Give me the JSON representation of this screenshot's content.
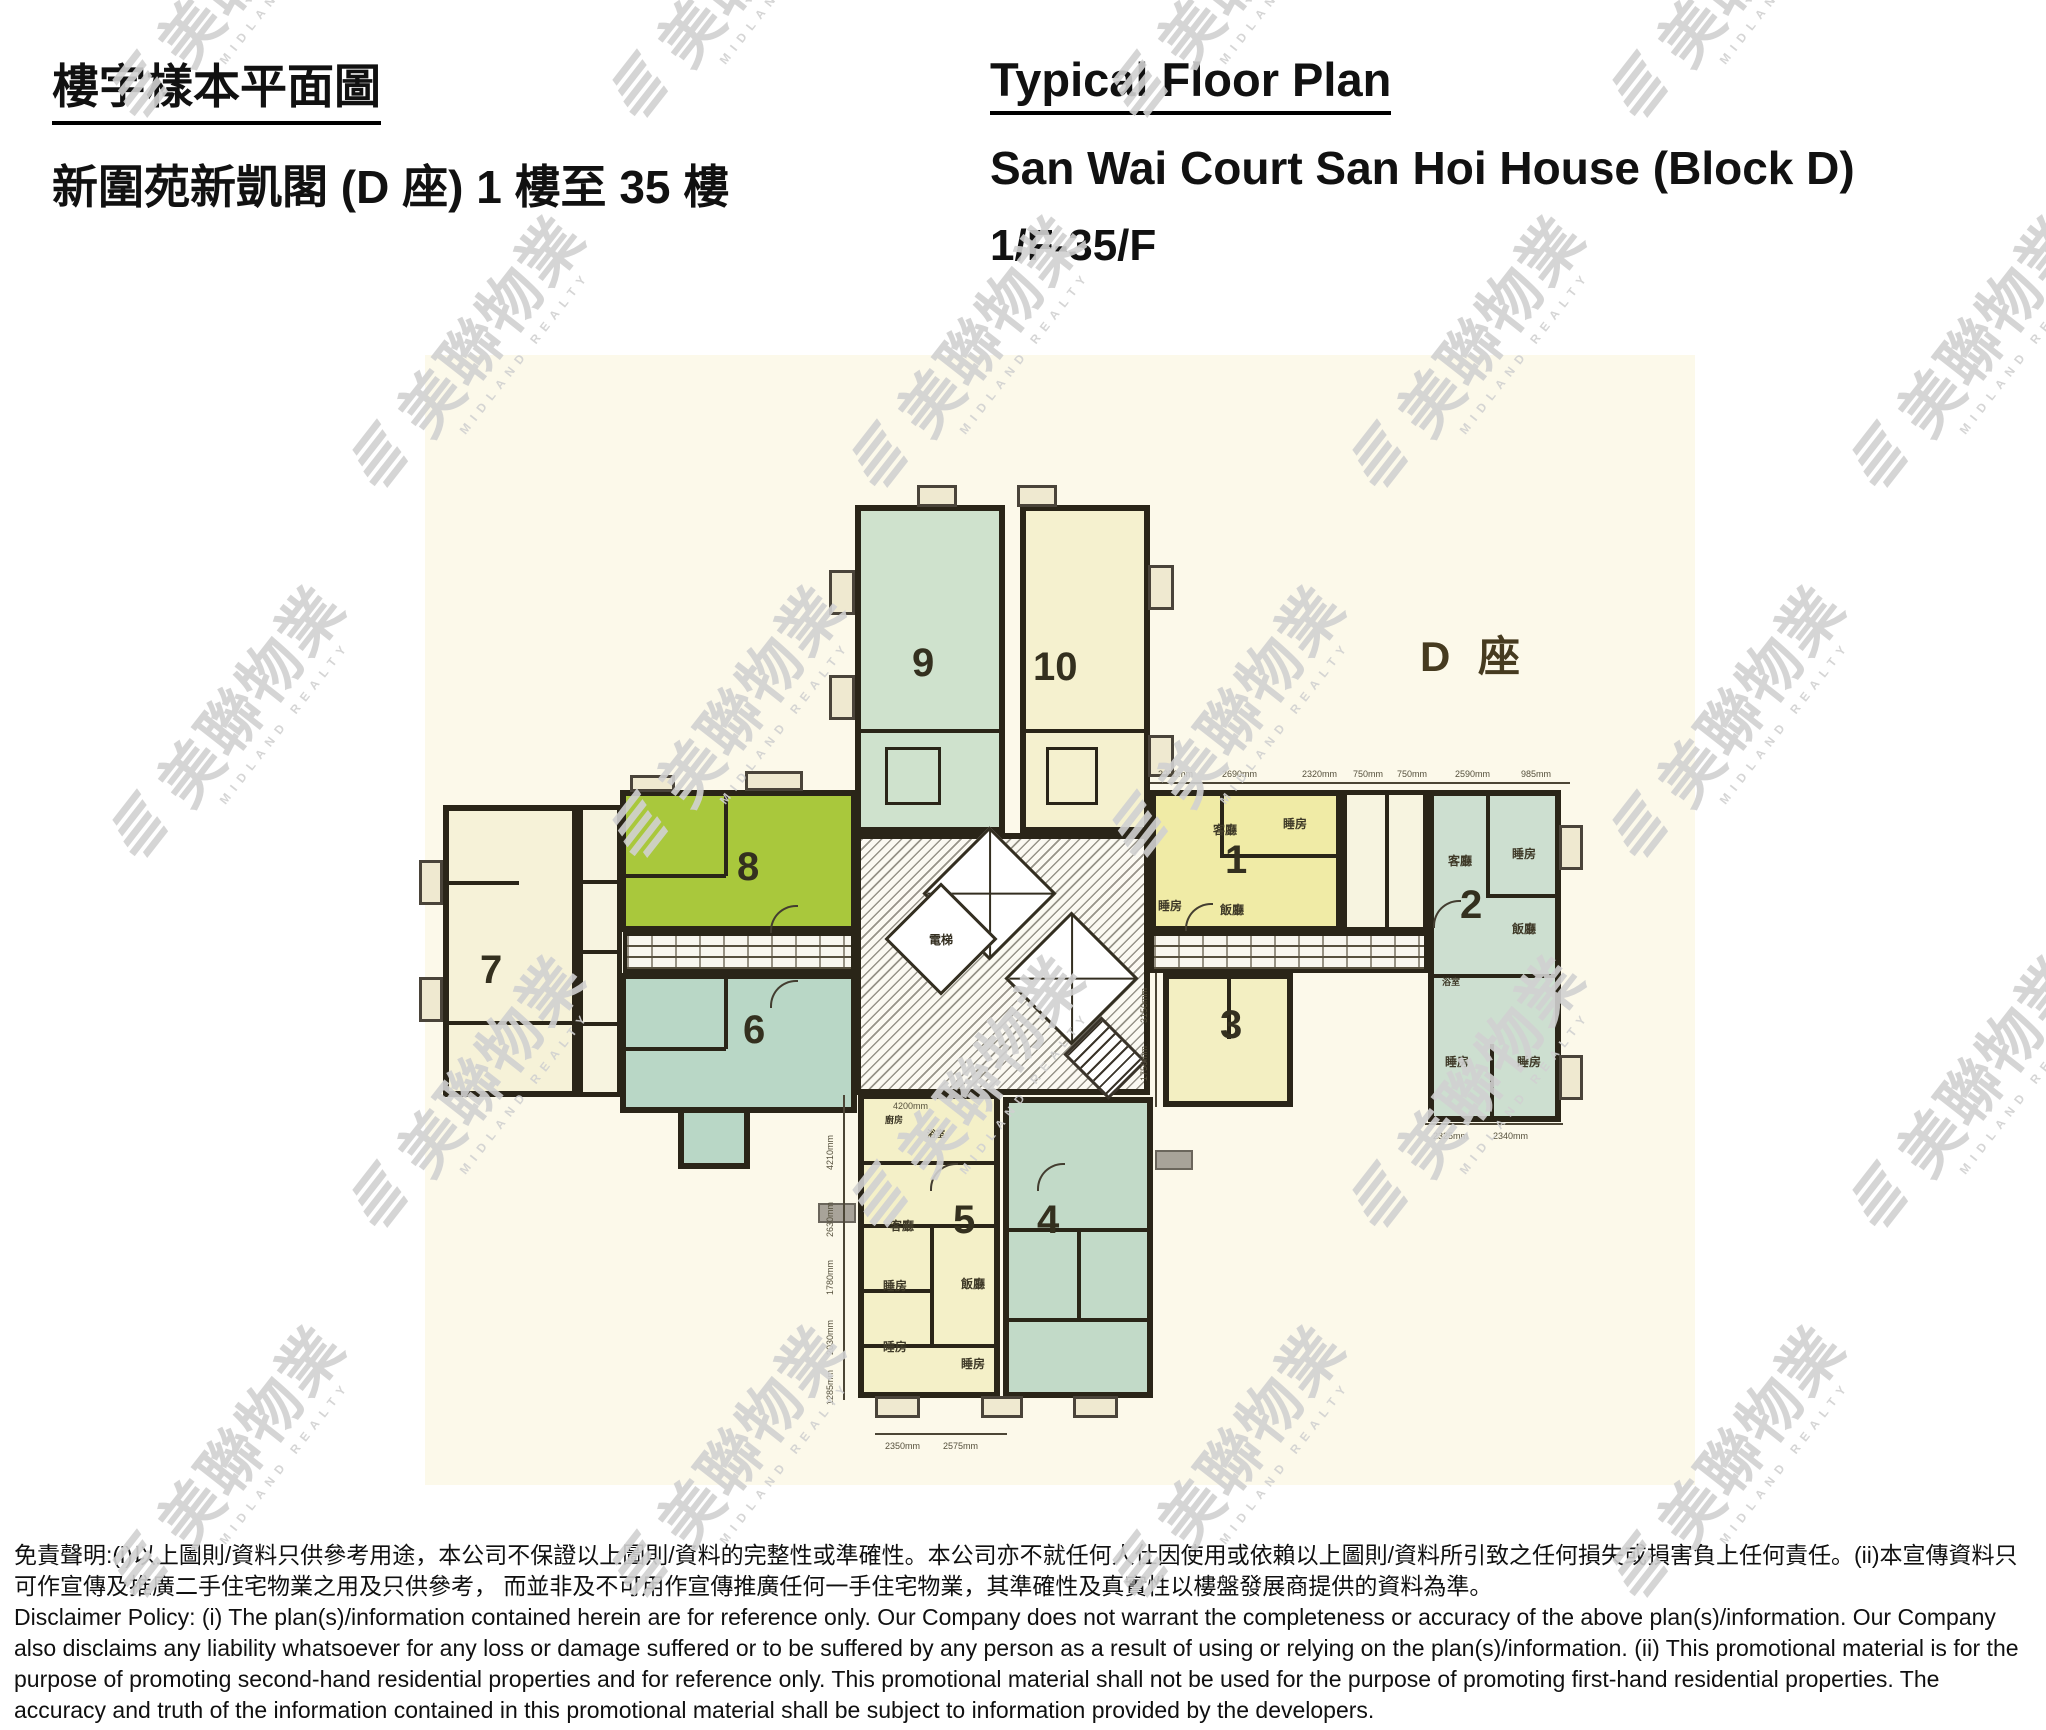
{
  "header": {
    "zh_title": "樓宇樣本平面圖",
    "zh_subtitle": "新圍苑新凱閣  (D 座) 1 樓至 35 樓",
    "en_title": "Typical Floor Plan",
    "en_subtitle": "San Wai Court San Hoi House (Block D)",
    "en_floors": "1/F-35/F"
  },
  "plan": {
    "block_label": "D 座",
    "labels": {
      "living": "客廳",
      "bedroom": "睡房",
      "dining": "飯廳",
      "bath": "浴室",
      "kitchen": "廚房",
      "lift": "電梯"
    },
    "units": [
      {
        "no": "1",
        "color": "#f0eba6"
      },
      {
        "no": "2",
        "color": "#cddfd0"
      },
      {
        "no": "3",
        "color": "#f3efc2"
      },
      {
        "no": "4",
        "color": "#c2dac8"
      },
      {
        "no": "5",
        "color": "#f4f0c8"
      },
      {
        "no": "6",
        "color": "#b9d7c6"
      },
      {
        "no": "7",
        "color": "#f6f2d8"
      },
      {
        "no": "8",
        "color": "#a9c83c"
      },
      {
        "no": "9",
        "color": "#cfe2cd"
      },
      {
        "no": "10",
        "color": "#f5f1cf"
      }
    ],
    "dims": {
      "top": [
        "2250mm",
        "2690mm",
        "2320mm",
        "750mm",
        "750mm",
        "2590mm",
        "985mm"
      ],
      "right_bottom": [
        "2325mm",
        "2340mm"
      ],
      "bottom": [
        "2350mm",
        "2575mm"
      ],
      "left_vertical": [
        "4210mm",
        "2630mm",
        "1780mm",
        "2030mm",
        "1285mm"
      ],
      "unit3_vertical": [
        "3150mm",
        "1750mm"
      ],
      "unit5_inner": "4200mm"
    }
  },
  "watermark": {
    "logo_text": "美聯物業",
    "subtext": "MIDLAND REALTY",
    "color": "#d7d7d7"
  },
  "disclaimer": {
    "zh": "免責聲明:(i)以上圖則/資料只供參考用途，本公司不保證以上圖則/資料的完整性或準確性。本公司亦不就任何人仕因使用或依賴以上圖則/資料所引致之任何損失或損害負上任何責任。(ii)本宣傳資料只可作宣傳及推廣二手住宅物業之用及只供參考， 而並非及不可用作宣傳推廣任何一手住宅物業，其準確性及真實性以樓盤發展商提供的資料為準。",
    "en": "Disclaimer Policy: (i) The plan(s)/information contained herein are for reference only. Our Company does not warrant the completeness or accuracy of the above plan(s)/information. Our Company also disclaims any liability whatsoever for any loss or damage suffered or to be suffered by any person as a result of using or relying on the plan(s)/information. (ii) This promotional material is for the purpose of promoting second-hand residential properties and for reference only. This promotional material shall not be used for the purpose of promoting first-hand residential properties. The accuracy and truth of the information contained in this promotional material shall be subject to information provided by the developers."
  }
}
